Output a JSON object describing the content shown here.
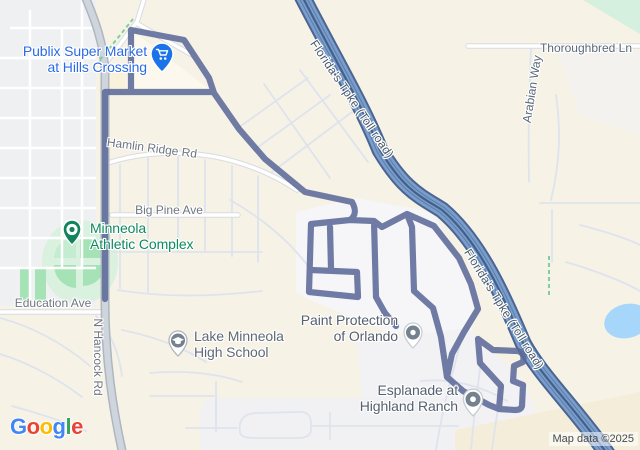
{
  "map_labels": {
    "publix": {
      "line1": "Publix Super Market",
      "line2": "at Hills Crossing",
      "color": "#2b6be4"
    },
    "minneola": {
      "line1": "Minneola",
      "line2": "Athletic Complex",
      "color": "#0e8a5f"
    },
    "school": {
      "line1": "Lake Minneola",
      "line2": "High School",
      "color": "#5f6a75"
    },
    "paint": {
      "line1": "Paint Protection",
      "line2": "of Orlando",
      "color": "#566070"
    },
    "esplanade": {
      "line1": "Esplanade at",
      "line2": "Highland Ranch",
      "color": "#566070"
    }
  },
  "road_labels": {
    "hamlin_ridge": "Hamlin Ridge Rd",
    "big_pine": "Big Pine Ave",
    "education": "Education Ave",
    "n_hancock": "N Hancock Rd",
    "thoroughbred": "Thoroughbred Ln",
    "arabian": "Arabian Way",
    "florida_tpke": "Florida's Tpke (Toll road)"
  },
  "attribution": {
    "text": "Map data ©2025"
  },
  "logo": {
    "letters": [
      {
        "char": "G",
        "color": "#4285F4"
      },
      {
        "char": "o",
        "color": "#EA4335"
      },
      {
        "char": "o",
        "color": "#FBBC05"
      },
      {
        "char": "g",
        "color": "#4285F4"
      },
      {
        "char": "l",
        "color": "#34A853"
      },
      {
        "char": "e",
        "color": "#EA4335"
      }
    ]
  },
  "icons": {
    "publix_pin": "shopping-cart-pin-icon",
    "minneola_pin": "park-pin-icon",
    "school_pin": "graduation-cap-pin-icon",
    "paint_pin": "poi-dot-pin-icon",
    "esplanade_pin": "poi-dot-pin-icon"
  },
  "colors": {
    "land": "#f6f2e6",
    "route": "#5b6898",
    "turnpike_fill": "#7b9dc9",
    "turnpike_casing": "#4a6593",
    "water": "#a6d6f9",
    "park_green": "#a5e3b6",
    "business_blue": "#1a73e8",
    "park_pin_green": "#12835c"
  }
}
